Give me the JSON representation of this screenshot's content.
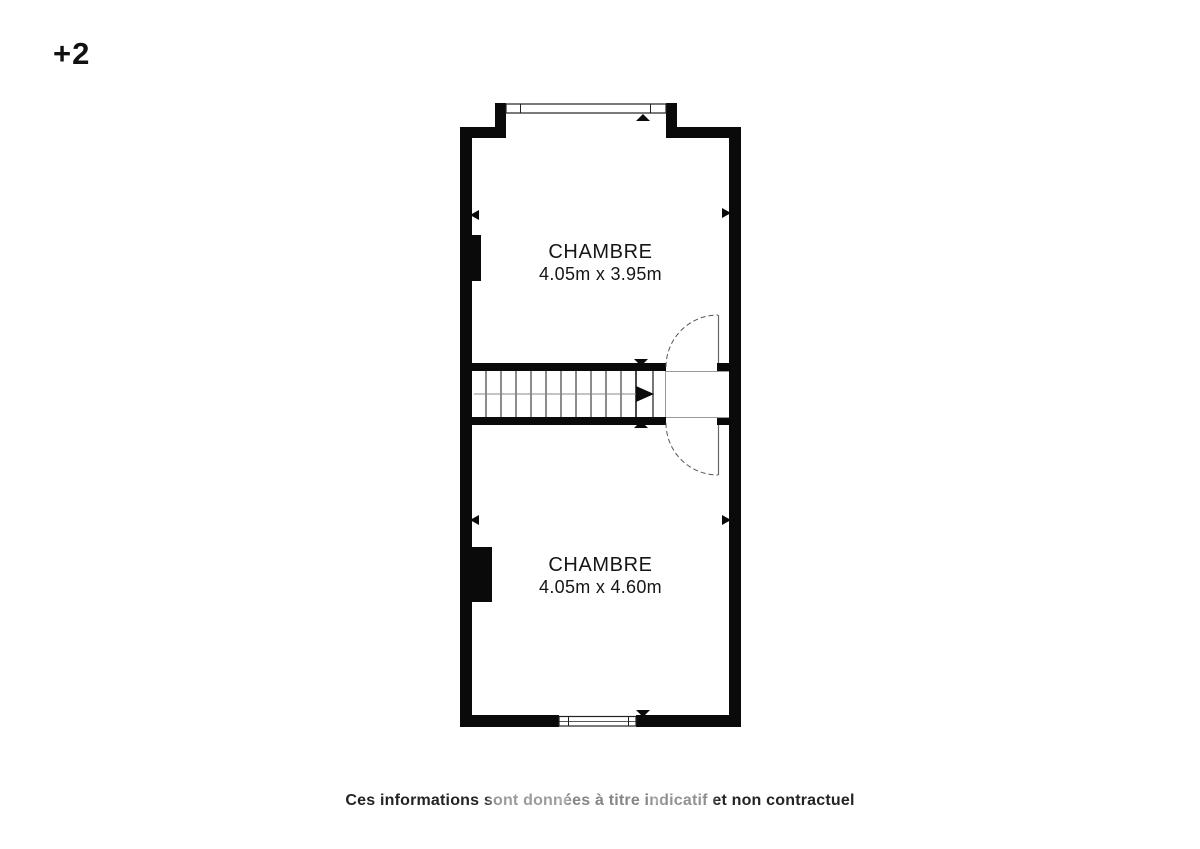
{
  "floor_label": "+2",
  "plan": {
    "rooms": [
      {
        "name": "CHAMBRE",
        "dimensions": "4.05m x 3.95m"
      },
      {
        "name": "CHAMBRE",
        "dimensions": "4.05m x 4.60m"
      }
    ],
    "features": [
      "stairs",
      "door-upper",
      "door-lower",
      "window-top",
      "window-bottom",
      "chimney-upper",
      "chimney-lower"
    ]
  },
  "disclaimer": "Ces informations sont données à titre indicatif et non contractuel",
  "colors": {
    "background": "#ffffff",
    "wall": "#0a0a0a",
    "window_line": "#222222",
    "stair_line": "#1a1a1a",
    "guide_line": "#999999",
    "door_line": "#555555",
    "text": "#1a1a1a"
  }
}
